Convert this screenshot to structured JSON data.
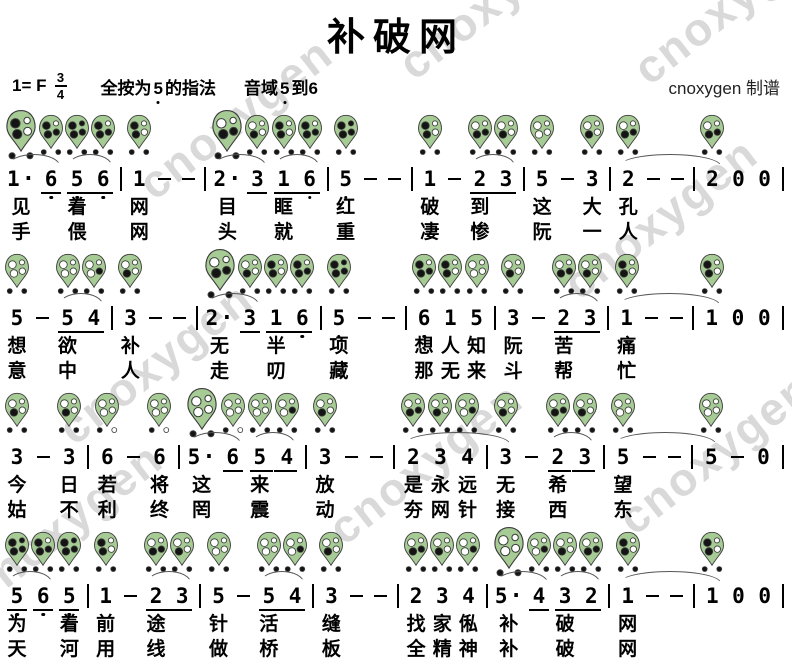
{
  "title": "补破网",
  "header": {
    "key_label": "1= F",
    "time_numerator": "3",
    "time_denominator": "4",
    "fingering_prefix": "全按为",
    "fingering_note": "5",
    "fingering_suffix": "的指法",
    "range_label": "音域",
    "range_from": "5",
    "range_to_label": "到",
    "range_to": "6",
    "credit": "cnoxygen 制谱"
  },
  "watermark": {
    "text": "cnoxygen",
    "color": "#d9d9d9",
    "positions": [
      {
        "x": 380,
        "y": -35
      },
      {
        "x": 615,
        "y": -30
      },
      {
        "x": 120,
        "y": 85
      },
      {
        "x": 545,
        "y": 185
      },
      {
        "x": 40,
        "y": 330
      },
      {
        "x": 310,
        "y": 430
      },
      {
        "x": 600,
        "y": 420
      },
      {
        "x": -50,
        "y": 490
      }
    ]
  },
  "colors": {
    "leaf": "#a6cb95",
    "leaf_border": "#3c3c3c",
    "hole_filled": "#141414",
    "hole_open": "#ffffff",
    "slur": "#555555"
  },
  "fingerings": {
    "5L": {
      "holes": [
        1,
        1,
        1,
        1
      ],
      "thumb": [
        1,
        1
      ]
    },
    "6L": {
      "holes": [
        1,
        0,
        1,
        1
      ],
      "thumb": [
        1,
        1
      ]
    },
    "1": {
      "holes": [
        1,
        0,
        1,
        0
      ],
      "thumb": [
        1,
        1
      ]
    },
    "2": {
      "holes": [
        0,
        0,
        1,
        1
      ],
      "thumb": [
        1,
        1
      ]
    },
    "3": {
      "holes": [
        0,
        0,
        1,
        0
      ],
      "thumb": [
        1,
        1
      ]
    },
    "4": {
      "holes": [
        0,
        0,
        0,
        1
      ],
      "thumb": [
        1,
        1
      ]
    },
    "5": {
      "holes": [
        0,
        0,
        0,
        0
      ],
      "thumb": [
        1,
        1
      ]
    },
    "6": {
      "holes": [
        0,
        0,
        0,
        0
      ],
      "thumb": [
        1,
        0
      ]
    }
  },
  "systems": [
    {
      "tokens": [
        {
          "t": "n",
          "n": "1",
          "d": 1,
          "f": "1",
          "a": 2,
          "l1": "见",
          "l2": "手"
        },
        {
          "t": "n",
          "n": "6",
          "o": -1,
          "u": "solo",
          "f": "6L"
        },
        {
          "t": "n",
          "n": "5",
          "o": -1,
          "u": "start",
          "f": "5L",
          "a": 2,
          "l1": "着",
          "l2": "偎"
        },
        {
          "t": "n",
          "n": "6",
          "o": -1,
          "u": "end",
          "f": "6L"
        },
        {
          "t": "b"
        },
        {
          "t": "n",
          "n": "1",
          "f": "1",
          "l1": "网",
          "l2": "网"
        },
        {
          "t": "-"
        },
        {
          "t": "-"
        },
        {
          "t": "b"
        },
        {
          "t": "n",
          "n": "2",
          "d": 1,
          "f": "2",
          "a": 2,
          "l1": "目",
          "l2": "头"
        },
        {
          "t": "n",
          "n": "3",
          "u": "solo",
          "f": "3"
        },
        {
          "t": "n",
          "n": "1",
          "u": "start",
          "f": "1",
          "a": 2,
          "l1": "眶",
          "l2": "就"
        },
        {
          "t": "n",
          "n": "6",
          "o": -1,
          "u": "end",
          "f": "6L"
        },
        {
          "t": "b"
        },
        {
          "t": "n",
          "n": "5",
          "o": -1,
          "f": "5L",
          "l1": "红",
          "l2": "重"
        },
        {
          "t": "-"
        },
        {
          "t": "-"
        },
        {
          "t": "b"
        },
        {
          "t": "n",
          "n": "1",
          "f": "1",
          "l1": "破",
          "l2": "凄"
        },
        {
          "t": "-"
        },
        {
          "t": "n",
          "n": "2",
          "u": "start",
          "f": "2",
          "a": 2,
          "l1": "到",
          "l2": "惨"
        },
        {
          "t": "n",
          "n": "3",
          "u": "end",
          "f": "3"
        },
        {
          "t": "b"
        },
        {
          "t": "n",
          "n": "5",
          "f": "5",
          "l1": "这",
          "l2": "阮"
        },
        {
          "t": "-"
        },
        {
          "t": "n",
          "n": "3",
          "f": "3",
          "l1": "大",
          "l2": "一"
        },
        {
          "t": "b"
        },
        {
          "t": "n",
          "n": "2",
          "f": "2",
          "a": 5,
          "l1": "孔",
          "l2": "人"
        },
        {
          "t": "-"
        },
        {
          "t": "-"
        },
        {
          "t": "b"
        },
        {
          "t": "n",
          "n": "2",
          "f": "2"
        },
        {
          "t": "n",
          "n": "0"
        },
        {
          "t": "n",
          "n": "0"
        },
        {
          "t": "b"
        }
      ]
    },
    {
      "tokens": [
        {
          "t": "n",
          "n": "5",
          "f": "5",
          "l1": "想",
          "l2": "意"
        },
        {
          "t": "-"
        },
        {
          "t": "n",
          "n": "5",
          "u": "start",
          "f": "5",
          "a": 2,
          "l1": "欲",
          "l2": "中"
        },
        {
          "t": "n",
          "n": "4",
          "u": "end",
          "f": "4"
        },
        {
          "t": "b"
        },
        {
          "t": "n",
          "n": "3",
          "f": "3",
          "l1": "补",
          "l2": "人"
        },
        {
          "t": "-"
        },
        {
          "t": "-"
        },
        {
          "t": "b"
        },
        {
          "t": "n",
          "n": "2",
          "d": 1,
          "f": "2",
          "a": 2,
          "l1": "无",
          "l2": "走"
        },
        {
          "t": "n",
          "n": "3",
          "u": "solo",
          "f": "3"
        },
        {
          "t": "n",
          "n": "1",
          "u": "start",
          "f": "1",
          "l1": "半",
          "l2": "叨"
        },
        {
          "t": "n",
          "n": "6",
          "o": -1,
          "u": "end",
          "f": "6L"
        },
        {
          "t": "b"
        },
        {
          "t": "n",
          "n": "5",
          "o": -1,
          "f": "5L",
          "l1": "项",
          "l2": "藏"
        },
        {
          "t": "-"
        },
        {
          "t": "-"
        },
        {
          "t": "b"
        },
        {
          "t": "n",
          "n": "6",
          "o": -1,
          "f": "6L",
          "l1": "想",
          "l2": "那"
        },
        {
          "t": "n",
          "n": "1",
          "f": "1",
          "l1": "人",
          "l2": "无"
        },
        {
          "t": "n",
          "n": "5",
          "f": "5",
          "l1": "知",
          "l2": "来"
        },
        {
          "t": "b"
        },
        {
          "t": "n",
          "n": "3",
          "f": "3",
          "l1": "阮",
          "l2": "斗"
        },
        {
          "t": "-"
        },
        {
          "t": "n",
          "n": "2",
          "u": "start",
          "f": "2",
          "a": 2,
          "l1": "苦",
          "l2": "帮"
        },
        {
          "t": "n",
          "n": "3",
          "u": "end",
          "f": "3"
        },
        {
          "t": "b"
        },
        {
          "t": "n",
          "n": "1",
          "f": "1",
          "a": 5,
          "l1": "痛",
          "l2": "忙"
        },
        {
          "t": "-"
        },
        {
          "t": "-"
        },
        {
          "t": "b"
        },
        {
          "t": "n",
          "n": "1",
          "f": "1"
        },
        {
          "t": "n",
          "n": "0"
        },
        {
          "t": "n",
          "n": "0"
        },
        {
          "t": "b"
        }
      ]
    },
    {
      "tokens": [
        {
          "t": "n",
          "n": "3",
          "f": "3",
          "l1": "今",
          "l2": "姑"
        },
        {
          "t": "-"
        },
        {
          "t": "n",
          "n": "3",
          "f": "3",
          "l1": "日",
          "l2": "不"
        },
        {
          "t": "b"
        },
        {
          "t": "n",
          "n": "6",
          "f": "6",
          "l1": "若",
          "l2": "利"
        },
        {
          "t": "-"
        },
        {
          "t": "n",
          "n": "6",
          "f": "6",
          "l1": "将",
          "l2": "终"
        },
        {
          "t": "b"
        },
        {
          "t": "n",
          "n": "5",
          "d": 1,
          "f": "5",
          "a": 2,
          "l1": "这",
          "l2": "罔"
        },
        {
          "t": "n",
          "n": "6",
          "u": "solo",
          "f": "6"
        },
        {
          "t": "n",
          "n": "5",
          "u": "start",
          "f": "5",
          "a": 2,
          "l1": "来",
          "l2": "震"
        },
        {
          "t": "n",
          "n": "4",
          "u": "end",
          "f": "4"
        },
        {
          "t": "b"
        },
        {
          "t": "n",
          "n": "3",
          "f": "3",
          "l1": "放",
          "l2": "动"
        },
        {
          "t": "-"
        },
        {
          "t": "-"
        },
        {
          "t": "b"
        },
        {
          "t": "n",
          "n": "2",
          "f": "2",
          "a": 5,
          "l1": "是",
          "l2": "夯"
        },
        {
          "t": "n",
          "n": "3",
          "f": "3",
          "l1": "永",
          "l2": "网"
        },
        {
          "t": "n",
          "n": "4",
          "f": "4",
          "l1": "远",
          "l2": "针"
        },
        {
          "t": "b"
        },
        {
          "t": "n",
          "n": "3",
          "f": "3",
          "l1": "无",
          "l2": "接"
        },
        {
          "t": "-"
        },
        {
          "t": "n",
          "n": "2",
          "u": "start",
          "f": "2",
          "a": 2,
          "l1": "希",
          "l2": "西"
        },
        {
          "t": "n",
          "n": "3",
          "u": "end",
          "f": "3"
        },
        {
          "t": "b"
        },
        {
          "t": "n",
          "n": "5",
          "f": "5",
          "a": 5,
          "l1": "望",
          "l2": "东"
        },
        {
          "t": "-"
        },
        {
          "t": "-"
        },
        {
          "t": "b"
        },
        {
          "t": "n",
          "n": "5",
          "f": "5"
        },
        {
          "t": "-"
        },
        {
          "t": "n",
          "n": "0"
        },
        {
          "t": "b"
        }
      ]
    },
    {
      "tokens": [
        {
          "t": "n",
          "n": "5",
          "o": -1,
          "u": "solo",
          "f": "5L",
          "a": 2,
          "l1": "为",
          "l2": "天"
        },
        {
          "t": "n",
          "n": "6",
          "o": -1,
          "u": "solo",
          "f": "6L"
        },
        {
          "t": "n",
          "n": "5",
          "o": -1,
          "u": "solo",
          "f": "5L",
          "l1": "着",
          "l2": "河"
        },
        {
          "t": "b"
        },
        {
          "t": "n",
          "n": "1",
          "f": "1",
          "l1": "前",
          "l2": "用"
        },
        {
          "t": "-"
        },
        {
          "t": "n",
          "n": "2",
          "u": "start",
          "f": "2",
          "a": 2,
          "l1": "途",
          "l2": "线"
        },
        {
          "t": "n",
          "n": "3",
          "u": "end",
          "f": "3"
        },
        {
          "t": "b"
        },
        {
          "t": "n",
          "n": "5",
          "f": "5",
          "l1": "针",
          "l2": "做"
        },
        {
          "t": "-"
        },
        {
          "t": "n",
          "n": "5",
          "u": "start",
          "f": "5",
          "a": 2,
          "l1": "活",
          "l2": "桥"
        },
        {
          "t": "n",
          "n": "4",
          "u": "end",
          "f": "4"
        },
        {
          "t": "b"
        },
        {
          "t": "n",
          "n": "3",
          "f": "3",
          "l1": "缝",
          "l2": "板"
        },
        {
          "t": "-"
        },
        {
          "t": "-"
        },
        {
          "t": "b"
        },
        {
          "t": "n",
          "n": "2",
          "f": "2",
          "l1": "找",
          "l2": "全"
        },
        {
          "t": "n",
          "n": "3",
          "f": "3",
          "l1": "家",
          "l2": "精"
        },
        {
          "t": "n",
          "n": "4",
          "f": "4",
          "l1": "俬",
          "l2": "神"
        },
        {
          "t": "b"
        },
        {
          "t": "n",
          "n": "5",
          "d": 1,
          "f": "5",
          "a": 2,
          "l1": "补",
          "l2": "补"
        },
        {
          "t": "n",
          "n": "4",
          "u": "solo",
          "f": "4"
        },
        {
          "t": "n",
          "n": "3",
          "u": "start",
          "f": "3",
          "a": 2,
          "l1": "破",
          "l2": "破"
        },
        {
          "t": "n",
          "n": "2",
          "u": "end",
          "f": "2"
        },
        {
          "t": "b"
        },
        {
          "t": "n",
          "n": "1",
          "f": "1",
          "a": 5,
          "l1": "网",
          "l2": "网"
        },
        {
          "t": "-"
        },
        {
          "t": "-"
        },
        {
          "t": "b"
        },
        {
          "t": "n",
          "n": "1",
          "f": "1"
        },
        {
          "t": "n",
          "n": "0"
        },
        {
          "t": "n",
          "n": "0"
        },
        {
          "t": "b"
        }
      ]
    }
  ]
}
